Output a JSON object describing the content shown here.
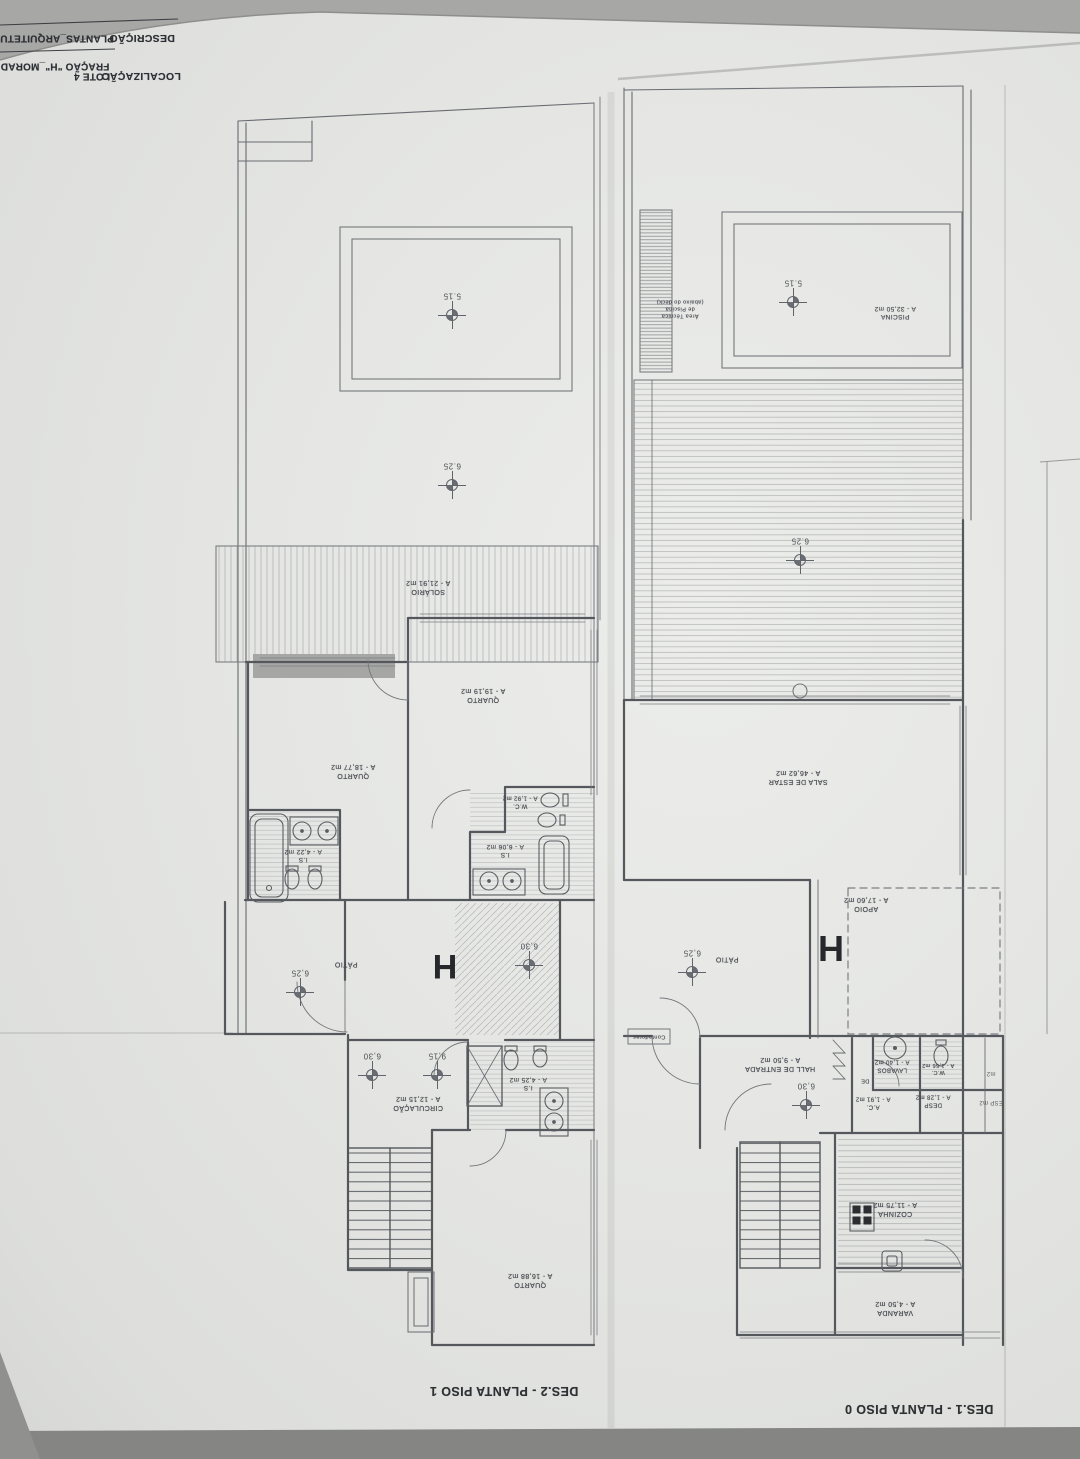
{
  "header": {
    "description_label": "DESCRIÇÃO",
    "description_value": "PLANTAS_ARQUITETU",
    "localization_label": "LOCALIZAÇÃO",
    "localization_value": "LOTE 4",
    "fraction_value": "FRAÇÃO \"H\"_MORAD"
  },
  "colors": {
    "paper": "#e6e6e4",
    "background": "#a7a7a5",
    "bottom_band": "#858583",
    "wall_line": "#54575b",
    "thin_line": "#686b70",
    "label_text": "#45484d",
    "unit_letter": "#26282b"
  },
  "plans": [
    {
      "name": "planta-piso-1",
      "title": "DES.2 - PLANTA PISO 1",
      "title_pos": {
        "x": 504,
        "y": 1391
      },
      "unit_letter": "H",
      "unit_letter_pos": {
        "x": 445,
        "y": 966,
        "size": 34
      },
      "room_labels": [
        {
          "name": "solario",
          "lines": [
            "SOLÁRIO",
            "A - 21,91 m2"
          ],
          "x": 428,
          "y": 586,
          "size": 7
        },
        {
          "name": "quarto-1",
          "lines": [
            "QUARTO",
            "A - 19,19 m2"
          ],
          "x": 483,
          "y": 694,
          "size": 7
        },
        {
          "name": "quarto-2",
          "lines": [
            "QUARTO",
            "A - 18,77 m2"
          ],
          "x": 353,
          "y": 770,
          "size": 7
        },
        {
          "name": "wc",
          "lines": [
            "W.C.",
            "A - 1,92 m2"
          ],
          "x": 520,
          "y": 801,
          "size": 6
        },
        {
          "name": "is-1",
          "lines": [
            "I.S",
            "A - 6,06 m2"
          ],
          "x": 505,
          "y": 850,
          "size": 6.5
        },
        {
          "name": "is-2",
          "lines": [
            "I.S",
            "A - 4,22 m2"
          ],
          "x": 303,
          "y": 855,
          "size": 6.5
        },
        {
          "name": "patio",
          "lines": [
            "PÁTIO"
          ],
          "x": 346,
          "y": 963,
          "size": 7
        },
        {
          "name": "circulacao",
          "lines": [
            "CIRCULAÇÃO",
            "A - 12,15 m2"
          ],
          "x": 418,
          "y": 1102,
          "size": 7
        },
        {
          "name": "is-3",
          "lines": [
            "I.S",
            "A - 4,25 m2"
          ],
          "x": 528,
          "y": 1083,
          "size": 6.5
        },
        {
          "name": "quarto-3",
          "lines": [
            "QUARTO",
            "A - 16,88 m2"
          ],
          "x": 530,
          "y": 1279,
          "size": 7
        }
      ],
      "dimension_markers": [
        {
          "value": "5.15",
          "x": 452,
          "y": 315
        },
        {
          "value": "6.25",
          "x": 452,
          "y": 485
        },
        {
          "value": "6,25",
          "x": 300,
          "y": 992
        },
        {
          "value": "6,30",
          "x": 529,
          "y": 965
        },
        {
          "value": "6,30",
          "x": 372,
          "y": 1075
        },
        {
          "value": "9,15",
          "x": 437,
          "y": 1075
        }
      ],
      "partial_labels": []
    },
    {
      "name": "planta-piso-0",
      "title": "DES.1 - PLANTA PISO 0",
      "title_pos": {
        "x": 919,
        "y": 1409
      },
      "unit_letter": "H",
      "unit_letter_pos": {
        "x": 831,
        "y": 948,
        "size": 36
      },
      "room_labels": [
        {
          "name": "piscina",
          "lines": [
            "PISCINA",
            "A - 32,50 m2"
          ],
          "x": 895,
          "y": 312,
          "size": 6.5
        },
        {
          "name": "area-tecnica",
          "lines": [
            "Área Técnica",
            "de Piscina",
            "(abaixo do deck)"
          ],
          "x": 680,
          "y": 308,
          "size": 5.5
        },
        {
          "name": "sala-de-estar",
          "lines": [
            "SALA DE ESTAR",
            "A - 46,62 m2"
          ],
          "x": 798,
          "y": 776,
          "size": 7
        },
        {
          "name": "apoio",
          "lines": [
            "APOIO",
            "A - 17,60 m2"
          ],
          "x": 866,
          "y": 903,
          "size": 7
        },
        {
          "name": "patio",
          "lines": [
            "PÁTIO"
          ],
          "x": 727,
          "y": 958,
          "size": 7
        },
        {
          "name": "contadores",
          "lines": [
            "Contadores"
          ],
          "x": 649,
          "y": 1036,
          "size": 5.5
        },
        {
          "name": "hall-de-entrada",
          "lines": [
            "HALL DE ENTRADA",
            "A - 9,50 m2"
          ],
          "x": 780,
          "y": 1063,
          "size": 7
        },
        {
          "name": "lavabos",
          "lines": [
            "LAVABOS",
            "A - 1,40 m2"
          ],
          "x": 892,
          "y": 1065,
          "size": 6
        },
        {
          "name": "wc",
          "lines": [
            "W.C.",
            "A - 1,56 m2"
          ],
          "x": 938,
          "y": 1068,
          "size": 5.5
        },
        {
          "name": "de-closet",
          "lines": [
            "DE"
          ],
          "x": 865,
          "y": 1080,
          "size": 5.5
        },
        {
          "name": "ac",
          "lines": [
            "A.C.",
            "A - 1,91 m2"
          ],
          "x": 873,
          "y": 1102,
          "size": 6
        },
        {
          "name": "desp",
          "lines": [
            "DESP",
            "A - 1,28 m2"
          ],
          "x": 933,
          "y": 1100,
          "size": 6
        },
        {
          "name": "cozinha",
          "lines": [
            "COZINHA",
            "A - 11,75 m2"
          ],
          "x": 895,
          "y": 1208,
          "size": 7
        },
        {
          "name": "varanda",
          "lines": [
            "VARANDA",
            "A - 4,50 m2"
          ],
          "x": 895,
          "y": 1307,
          "size": 7
        }
      ],
      "dimension_markers": [
        {
          "value": "5.15",
          "x": 793,
          "y": 302
        },
        {
          "value": "6.25",
          "x": 800,
          "y": 560
        },
        {
          "value": "6,25",
          "x": 692,
          "y": 972
        },
        {
          "value": "6,30",
          "x": 806,
          "y": 1105
        }
      ],
      "partial_labels": [
        {
          "text": "m2",
          "x": 991,
          "y": 1073
        },
        {
          "text": "ESP m2",
          "x": 991,
          "y": 1102
        }
      ]
    }
  ]
}
